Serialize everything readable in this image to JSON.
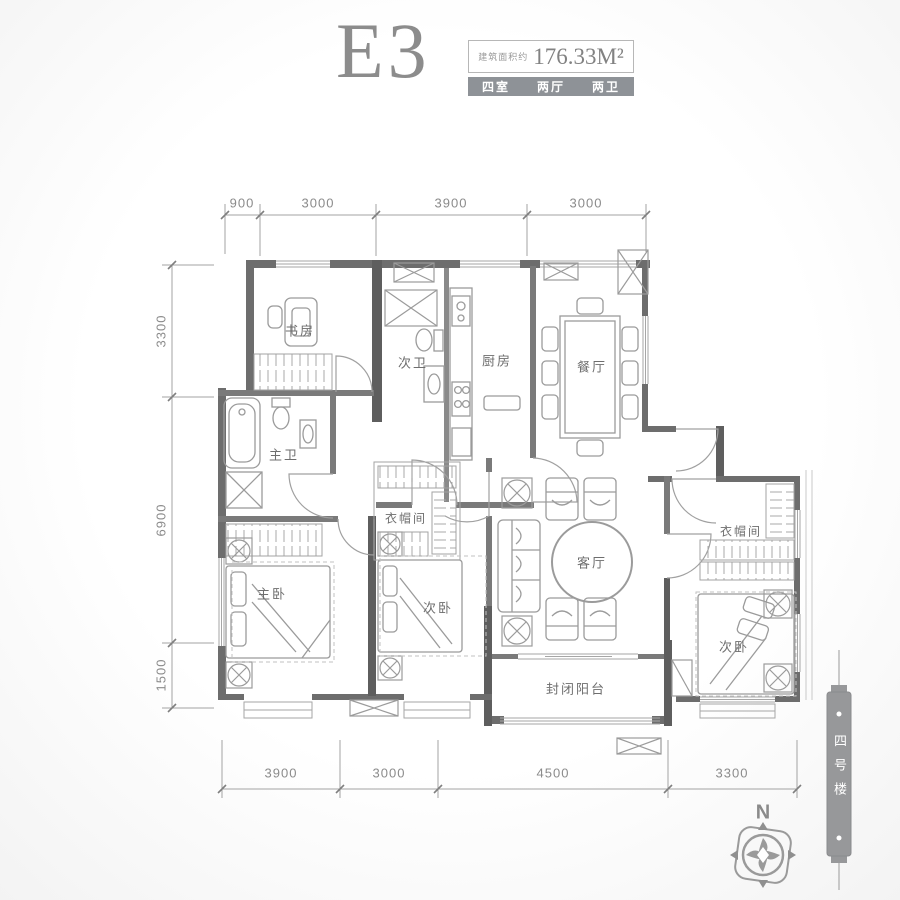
{
  "header": {
    "unit_name": "E3",
    "area_label": "建筑面积约",
    "area_value": "176.33M²",
    "badges": [
      "四室",
      "两厅",
      "两卫"
    ]
  },
  "dimensions": {
    "top": [
      "900",
      "3000",
      "3900",
      "3000"
    ],
    "left": [
      "3300",
      "6900",
      "1500"
    ],
    "bottom": [
      "3900",
      "3000",
      "4500",
      "3300"
    ]
  },
  "rooms": [
    {
      "id": "study",
      "label": "书房"
    },
    {
      "id": "bath2",
      "label": "次卫"
    },
    {
      "id": "kitchen",
      "label": "厨房"
    },
    {
      "id": "dining",
      "label": "餐厅"
    },
    {
      "id": "bath1",
      "label": "主卫"
    },
    {
      "id": "closet1",
      "label": "衣帽间"
    },
    {
      "id": "master",
      "label": "主卧"
    },
    {
      "id": "bed2",
      "label": "次卧"
    },
    {
      "id": "living",
      "label": "客厅"
    },
    {
      "id": "closet2",
      "label": "衣帽间"
    },
    {
      "id": "bed3",
      "label": "次卧"
    },
    {
      "id": "balcony",
      "label": "封闭阳台"
    }
  ],
  "compass": {
    "label": "N"
  },
  "building_marker": {
    "label": "四号楼"
  }
}
